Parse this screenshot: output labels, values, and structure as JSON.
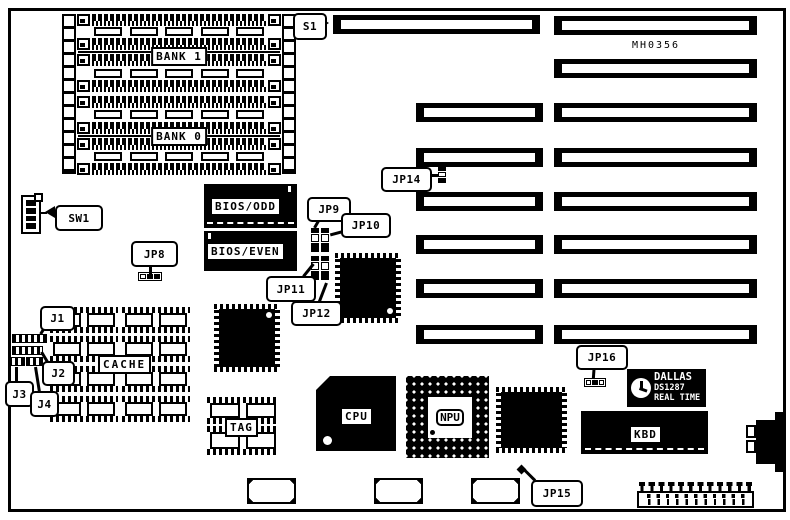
{
  "colors": {
    "ink": "#000000",
    "paper": "#ffffff"
  },
  "callouts": {
    "s1": "S1",
    "sw1": "SW1",
    "jp8": "JP8",
    "jp9": "JP9",
    "jp10": "JP10",
    "jp11": "JP11",
    "jp12": "JP12",
    "jp14": "JP14",
    "jp15": "JP15",
    "jp16": "JP16",
    "j1": "J1",
    "j2": "J2",
    "j3": "J3",
    "j4": "J4"
  },
  "chips": {
    "bank1": "BANK 1",
    "bank0": "BANK 0",
    "bios_odd": "BIOS/ODD",
    "bios_even": "BIOS/EVEN",
    "cache": "CACHE",
    "tag": "TAG",
    "cpu": "CPU",
    "npu": "NPU",
    "kbd": "KBD"
  },
  "texts": {
    "board_id": "MH0356",
    "rtc_brand": "DALLAS",
    "rtc_model": "DS1287",
    "rtc_type": "REAL TIME"
  }
}
